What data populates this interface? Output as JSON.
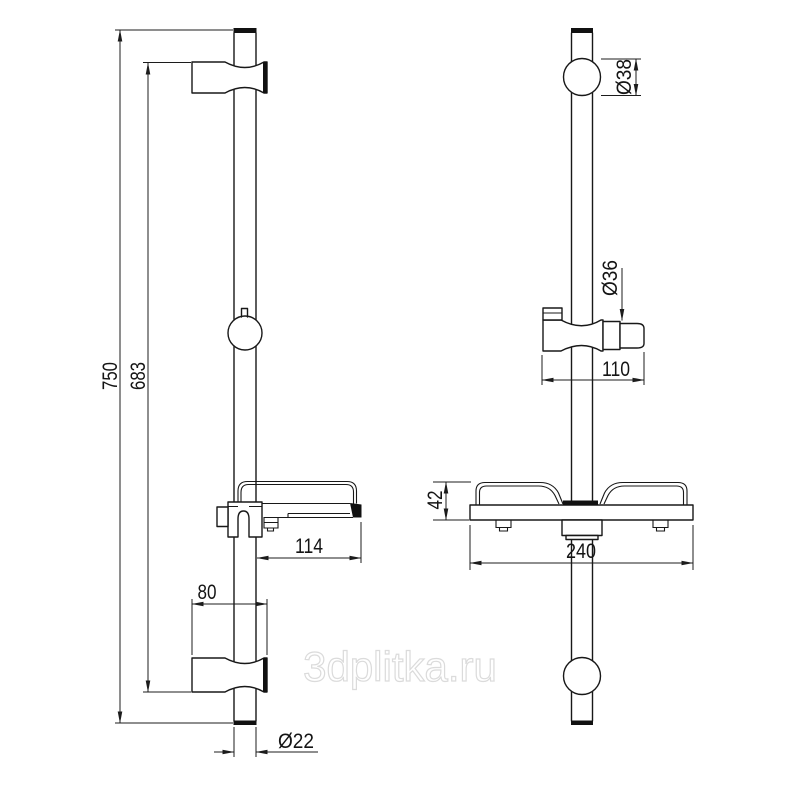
{
  "watermark": {
    "text": "3dplitka.ru"
  },
  "left_view": {
    "name": "side view of shower slide bar",
    "dims": {
      "overall_length": "750",
      "mount_span": "683",
      "soap_dish_depth": "114",
      "bracket_width": "80",
      "rail_diameter": "Ø22"
    }
  },
  "right_view": {
    "name": "front view of shower slide bar",
    "dims": {
      "top_mount_diameter": "Ø38",
      "holder_diameter": "Ø36",
      "holder_width": "110",
      "shelf_height": "42",
      "shelf_width": "240"
    }
  },
  "colors": {
    "line": "#181818",
    "background": "#ffffff",
    "watermark_outline": "#dbdbdb"
  }
}
